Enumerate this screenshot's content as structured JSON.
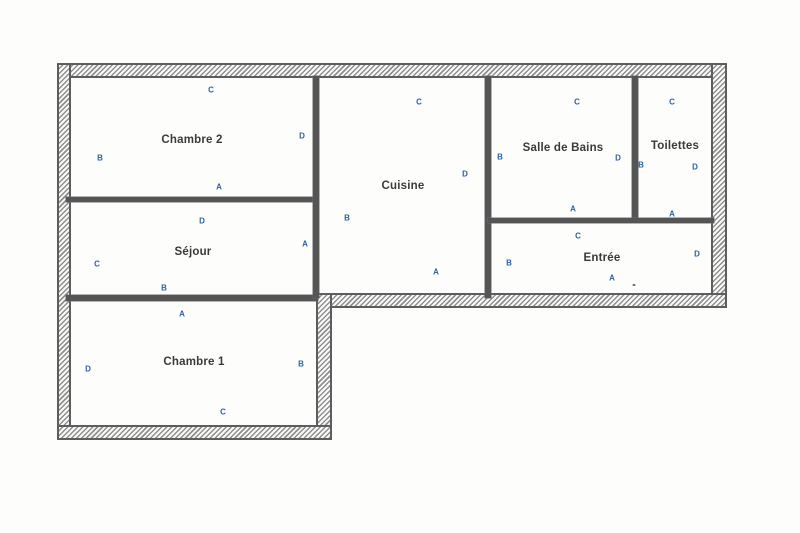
{
  "document_type": "floor-plan",
  "colors": {
    "background": "#fdfdfc",
    "letter_blue": "#2d62a0",
    "room_label": "#3a3a3a",
    "wall_line": "#5d5d5d",
    "hatch_gray": "#8f8f8f"
  },
  "rooms": [
    {
      "id": "chambre-2",
      "label": "Chambre 2",
      "label_pos": {
        "x": 192,
        "y": 140
      },
      "letters": [
        {
          "t": "C",
          "x": 211,
          "y": 90
        },
        {
          "t": "D",
          "x": 302,
          "y": 136
        },
        {
          "t": "B",
          "x": 100,
          "y": 158
        },
        {
          "t": "A",
          "x": 219,
          "y": 187
        }
      ]
    },
    {
      "id": "sejour",
      "label": "Séjour",
      "label_pos": {
        "x": 193,
        "y": 252
      },
      "letters": [
        {
          "t": "D",
          "x": 202,
          "y": 221
        },
        {
          "t": "A",
          "x": 305,
          "y": 244
        },
        {
          "t": "C",
          "x": 97,
          "y": 264
        },
        {
          "t": "B",
          "x": 164,
          "y": 288
        }
      ]
    },
    {
      "id": "chambre-1",
      "label": "Chambre 1",
      "label_pos": {
        "x": 194,
        "y": 362
      },
      "letters": [
        {
          "t": "A",
          "x": 182,
          "y": 314
        },
        {
          "t": "D",
          "x": 88,
          "y": 369
        },
        {
          "t": "B",
          "x": 301,
          "y": 364
        },
        {
          "t": "C",
          "x": 223,
          "y": 412
        }
      ]
    },
    {
      "id": "cuisine",
      "label": "Cuisine",
      "label_pos": {
        "x": 403,
        "y": 186
      },
      "letters": [
        {
          "t": "C",
          "x": 419,
          "y": 102
        },
        {
          "t": "D",
          "x": 465,
          "y": 174
        },
        {
          "t": "B",
          "x": 347,
          "y": 218
        },
        {
          "t": "A",
          "x": 436,
          "y": 272
        }
      ]
    },
    {
      "id": "salle-de-bains",
      "label": "Salle de Bains",
      "label_pos": {
        "x": 563,
        "y": 148
      },
      "letters": [
        {
          "t": "C",
          "x": 577,
          "y": 102
        },
        {
          "t": "B",
          "x": 500,
          "y": 157
        },
        {
          "t": "D",
          "x": 618,
          "y": 158
        },
        {
          "t": "A",
          "x": 573,
          "y": 209
        }
      ]
    },
    {
      "id": "toilettes",
      "label": "Toilettes",
      "label_pos": {
        "x": 675,
        "y": 146
      },
      "letters": [
        {
          "t": "C",
          "x": 672,
          "y": 102
        },
        {
          "t": "B",
          "x": 641,
          "y": 165
        },
        {
          "t": "D",
          "x": 695,
          "y": 167
        },
        {
          "t": "A",
          "x": 672,
          "y": 214
        }
      ]
    },
    {
      "id": "entree",
      "label": "Entrée",
      "label_pos": {
        "x": 602,
        "y": 258
      },
      "letters": [
        {
          "t": "C",
          "x": 578,
          "y": 236
        },
        {
          "t": "B",
          "x": 509,
          "y": 263
        },
        {
          "t": "D",
          "x": 697,
          "y": 254
        },
        {
          "t": "A",
          "x": 612,
          "y": 278
        }
      ]
    }
  ],
  "walls": {
    "exterior": [
      {
        "id": "outer-top",
        "x": 57,
        "y": 63,
        "w": 670,
        "h": 15
      },
      {
        "id": "outer-left",
        "x": 57,
        "y": 63,
        "w": 14,
        "h": 377
      },
      {
        "id": "outer-right",
        "x": 711,
        "y": 63,
        "w": 16,
        "h": 245
      },
      {
        "id": "upper-section-bottom",
        "x": 316,
        "y": 293,
        "w": 411,
        "h": 15
      },
      {
        "id": "extension-right",
        "x": 316,
        "y": 293,
        "w": 16,
        "h": 147
      },
      {
        "id": "extension-bottom",
        "x": 57,
        "y": 425,
        "w": 275,
        "h": 15
      }
    ],
    "interior": [
      {
        "id": "chambre2-sejour-divider",
        "x": 66,
        "y": 197,
        "w": 252,
        "h": 5
      },
      {
        "id": "sejour-chambre1-divider",
        "x": 66,
        "y": 295,
        "w": 252,
        "h": 6
      },
      {
        "id": "cuisine-left-wall",
        "x": 313,
        "y": 76,
        "w": 6,
        "h": 222
      },
      {
        "id": "cuisine-right-wall",
        "x": 485,
        "y": 76,
        "w": 6,
        "h": 222
      },
      {
        "id": "sdb-toilettes-divider",
        "x": 632,
        "y": 76,
        "w": 6,
        "h": 146
      },
      {
        "id": "entree-top-wall",
        "x": 488,
        "y": 218,
        "w": 226,
        "h": 5
      }
    ]
  },
  "stray_mark": {
    "x": 634,
    "y": 285
  }
}
